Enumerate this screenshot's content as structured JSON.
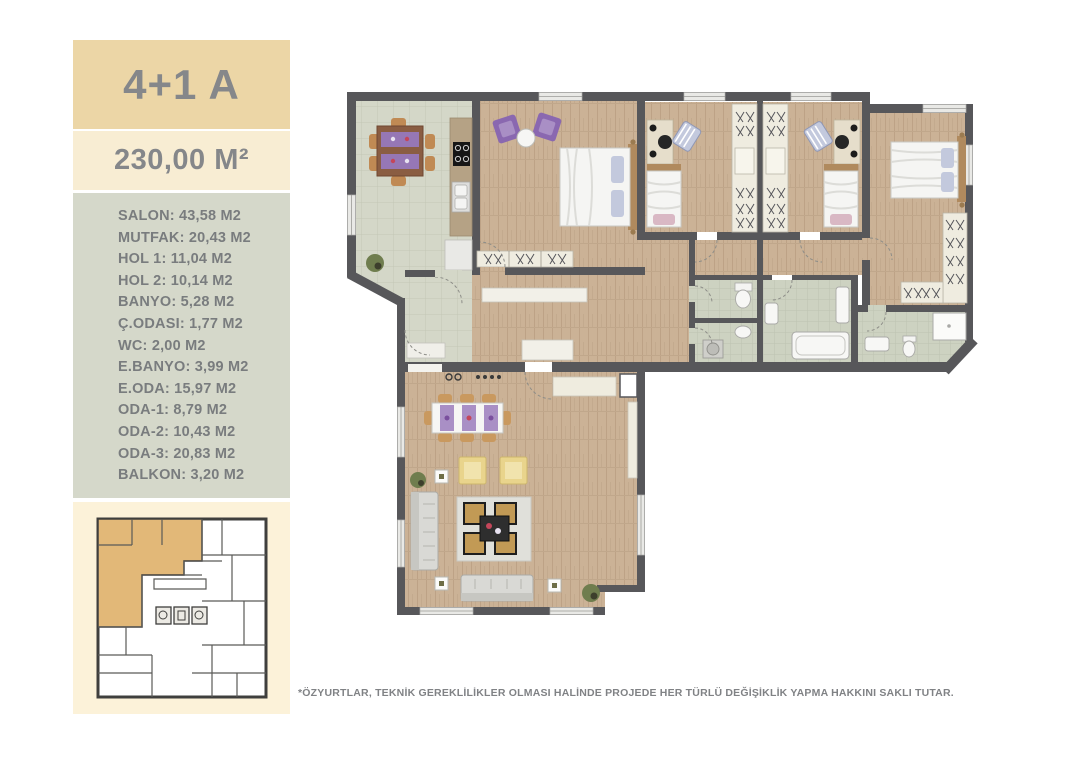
{
  "sidebar": {
    "unit_type": "4+1 A",
    "total_area": "230,00 M²",
    "room_lines": [
      "SALON: 43,58 M2",
      "MUTFAK: 20,43 M2",
      "HOL 1: 11,04 M2",
      "HOL 2: 10,14 M2",
      "BANYO: 5,28 M2",
      "Ç.ODASI: 1,77 M2",
      "WC: 2,00 M2",
      "E.BANYO: 3,99 M2",
      "E.ODA: 15,97 M2",
      "ODA-1: 8,79 M2",
      "ODA-2: 10,43 M2",
      "ODA-3: 20,83 M2",
      "BALKON: 3,20 M2"
    ]
  },
  "footer": {
    "disclaimer": "*ÖZYURTLAR, TEKNİK GEREKLİLİKLER OLMASI HALİNDE PROJEDE HER TÜRLÜ DEĞİŞİKLİK YAPMA HAKKINI SAKLI TUTAR."
  },
  "colors": {
    "accent_tan": "#ecd6a6",
    "cream_band": "#f8edd3",
    "list_bg": "#d5d8ca",
    "keyplan_bg": "#fcf2d9",
    "keyplan_highlight": "#e2b878",
    "text_gray": "#797c7e",
    "wall": "#57575a",
    "wood_floor": "#cbb296",
    "kitchen_tile": "#d4d7c8",
    "bath_tile": "#cdd2c1",
    "purple_furniture": "#8a68b0",
    "yellow_furniture": "#e9d48c"
  }
}
